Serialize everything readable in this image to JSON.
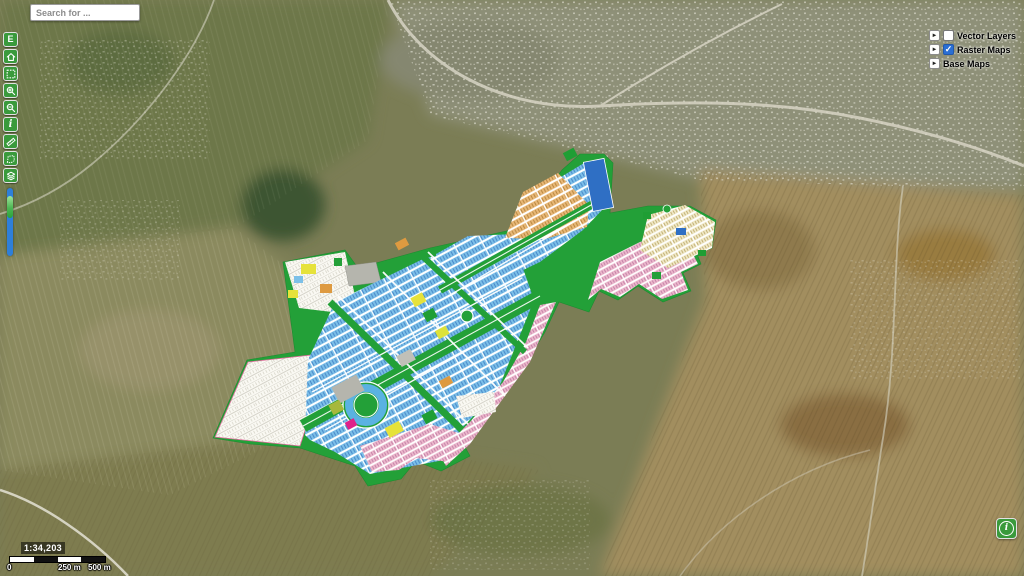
{
  "search": {
    "placeholder": "Search for ..."
  },
  "toolbar": {
    "buttons": [
      {
        "name": "edit-mode-button",
        "label": "E"
      },
      {
        "name": "home-button",
        "icon": "home-icon"
      },
      {
        "name": "zoom-extent-button",
        "icon": "extent-icon"
      },
      {
        "name": "zoom-in-button",
        "icon": "zoom-in-icon"
      },
      {
        "name": "zoom-out-button",
        "icon": "zoom-out-icon"
      },
      {
        "name": "identify-button",
        "label": "i",
        "icon": "info-icon"
      },
      {
        "name": "measure-length-button",
        "icon": "ruler-icon"
      },
      {
        "name": "measure-area-button",
        "icon": "area-icon"
      },
      {
        "name": "legend-button",
        "icon": "layers-icon"
      }
    ]
  },
  "layers_panel": {
    "expander_glyph": "►",
    "check_glyph": "✓",
    "items": [
      {
        "label": "Vector Layers",
        "has_checkbox": true,
        "checked": false
      },
      {
        "label": "Raster Maps",
        "has_checkbox": true,
        "checked": true
      },
      {
        "label": "Base Maps",
        "has_checkbox": false,
        "checked": false
      }
    ]
  },
  "scale": {
    "ratio": "1:34,203",
    "bar_labels": [
      "0",
      "250 m",
      "500 m"
    ]
  },
  "corner_info_button": {
    "label": "i"
  },
  "map": {
    "description": "Satellite basemap with housing-scheme master plan raster overlay",
    "overlay_colors": {
      "plan_green": "#23a038",
      "residential_blue": "#7cc0e8",
      "commercial_orange": "#e8b878",
      "parcel_pink": "#ecb8cc",
      "parcel_cream": "#f0e9c8",
      "undeveloped_white": "#faf9f4",
      "water_blue": "#2f6fc4",
      "highlight_yellow": "#e6e23a",
      "highlight_magenta": "#e0218a"
    },
    "ui_colors": {
      "toolbar_green": "#3a9a3c",
      "slider_blue": "#2e7fd9",
      "checkbox_blue": "#2a6fd4"
    }
  }
}
